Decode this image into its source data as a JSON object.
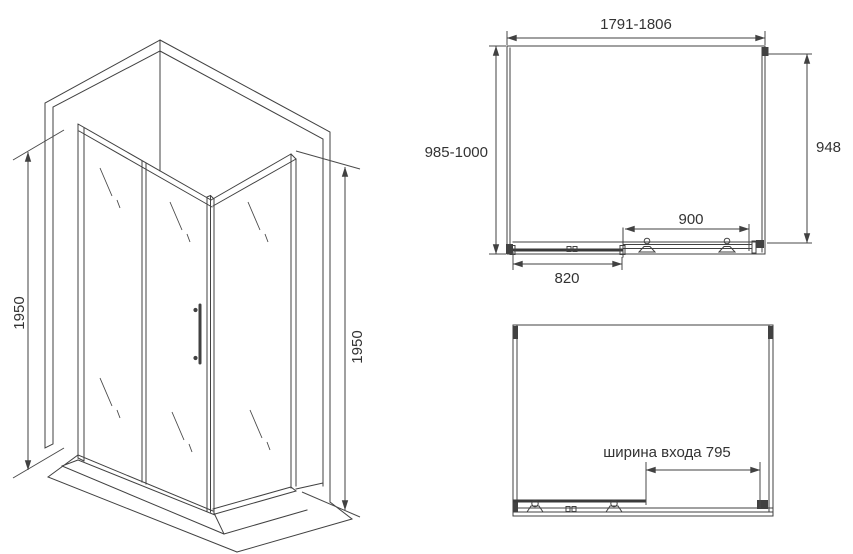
{
  "drawing_title": "shower-enclosure-technical-drawing",
  "colors": {
    "line": "#414141",
    "text": "#333333",
    "background": "#ffffff"
  },
  "isometric_view": {
    "height_left_label": "1950",
    "height_right_label": "1950"
  },
  "top_view": {
    "overall_width_label": "1791-1806",
    "depth_label": "985-1000",
    "side_panel_label": "948",
    "door_opening_label": "900",
    "fixed_panel_label": "820"
  },
  "front_view": {
    "entry_width_label": "ширина входа 795"
  }
}
